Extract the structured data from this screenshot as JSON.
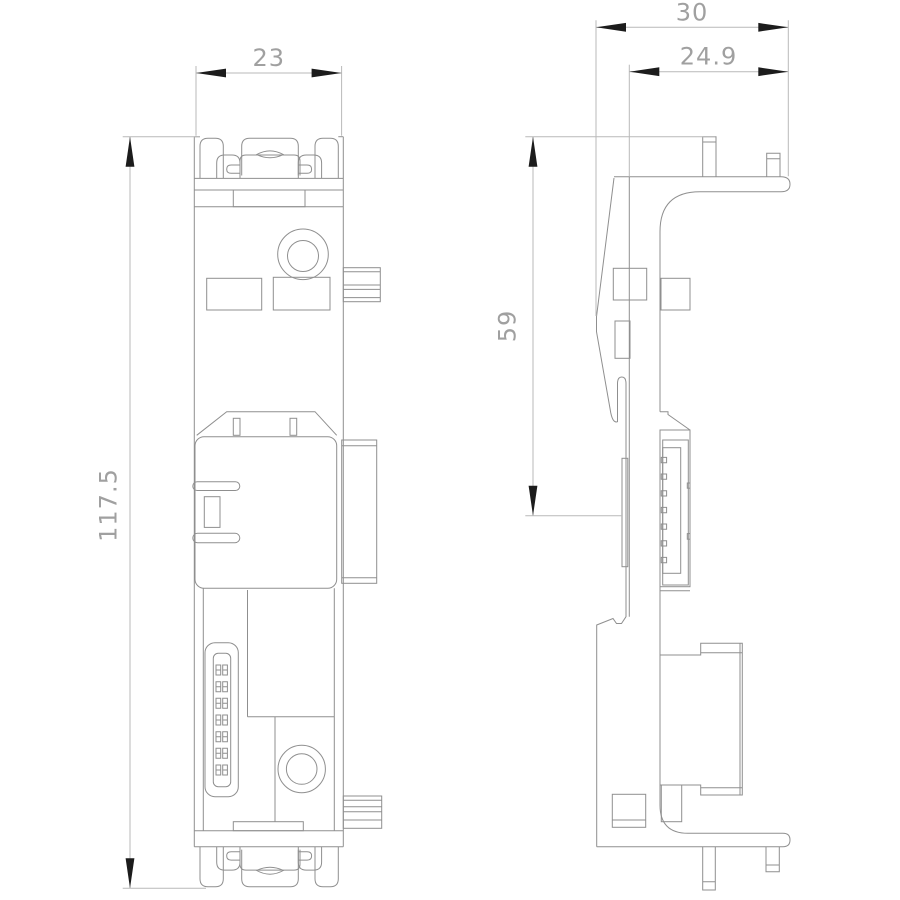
{
  "drawing": {
    "kind": "dimensional technical drawing, two orthographic views of a DIN-rail mounted terminal module",
    "views": {
      "left": "front view",
      "right": "side view"
    }
  },
  "dimensions": {
    "front_width": "23",
    "front_height": "117.5",
    "side_width": "30",
    "side_width_inner": "24.9",
    "side_clip_height": "59"
  },
  "colors": {
    "background": "#ffffff",
    "part_outline": "#8f8f8f",
    "dimension_line": "#b9b9b9",
    "dimension_text": "#a0a0a0",
    "arrow": "#1c1c1c"
  }
}
